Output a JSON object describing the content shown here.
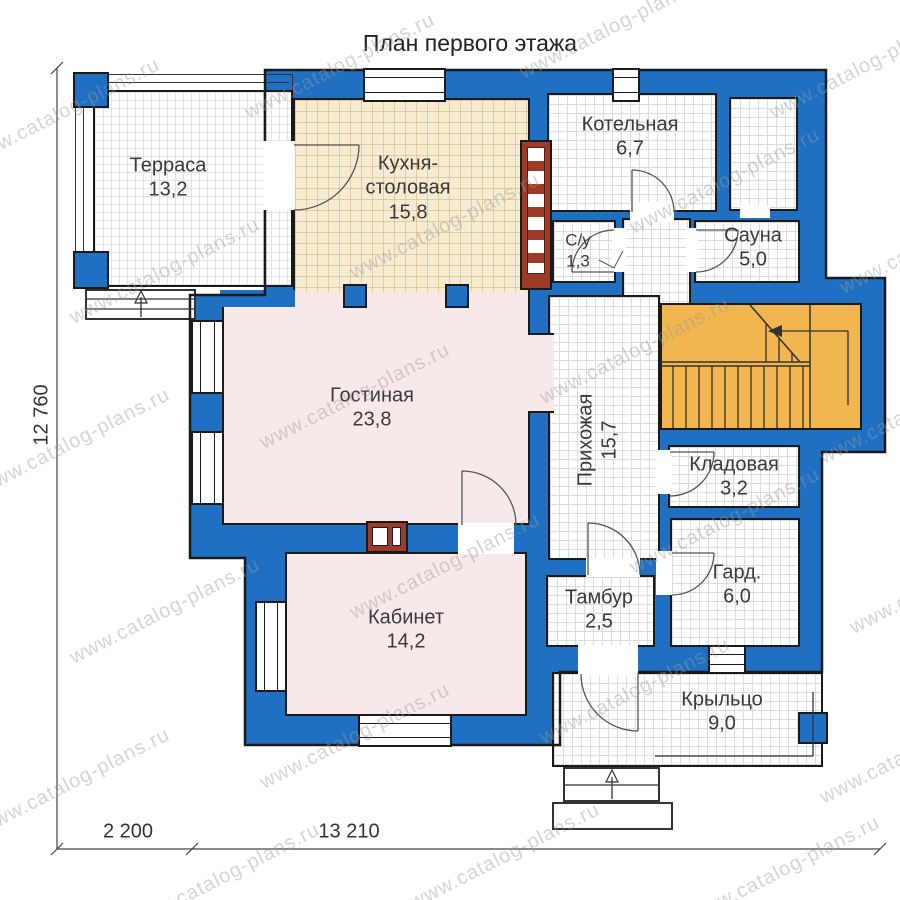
{
  "title": "План первого этажа",
  "watermark": {
    "text": "www.catalog-plans.ru"
  },
  "rooms": {
    "terrace": {
      "label": "Терраса",
      "area": "13,2"
    },
    "kitchen": {
      "label": "Кухня-столовая",
      "area": "15,8"
    },
    "boiler": {
      "label": "Котельная",
      "area": "6,7"
    },
    "wc": {
      "label": "С/у",
      "area": "1,3"
    },
    "sauna": {
      "label": "Сауна",
      "area": "5,0"
    },
    "living": {
      "label": "Гостиная",
      "area": "23,8"
    },
    "hallway": {
      "label": "Прихожая",
      "area": "15,7"
    },
    "storage": {
      "label": "Кладовая",
      "area": "3,2"
    },
    "wardrobe": {
      "label": "Гард.",
      "area": "6,0"
    },
    "study": {
      "label": "Кабинет",
      "area": "14,2"
    },
    "vestibule": {
      "label": "Тамбур",
      "area": "2,5"
    },
    "porch": {
      "label": "Крыльцо",
      "area": "9,0"
    }
  },
  "dimensions": {
    "height_total": "12 760",
    "width_porch": "2 200",
    "width_main": "13 210"
  },
  "colors": {
    "wall_blue": "#1f6fc2",
    "stairs_orange": "#f1b64f",
    "brick_red": "#9e3b28",
    "kitchen_beige": "#f6ecd2",
    "room_pink": "#f7e9ea"
  }
}
